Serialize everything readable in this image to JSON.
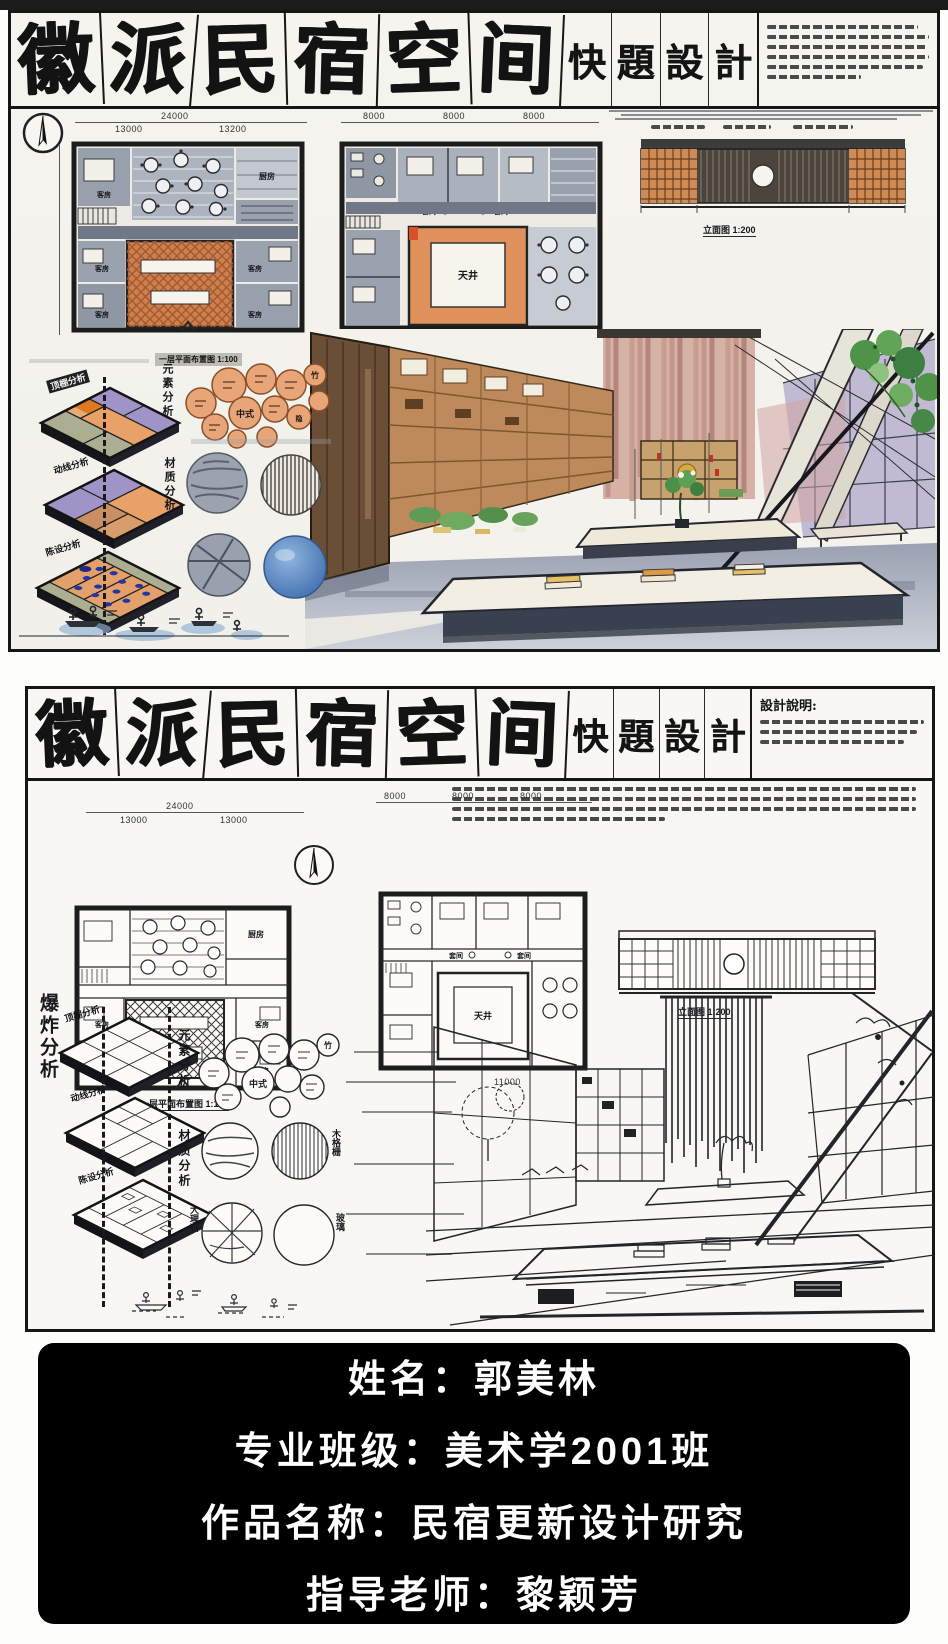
{
  "colors": {
    "ink": "#1a1a1a",
    "paper": "#f4f3ee",
    "wall_gray": "#98a0ad",
    "courtyard_orange": "#cf7f4e",
    "frame_orange": "#e0915c",
    "plate_orange": "#e8a268",
    "plate_purple": "#9f93c8",
    "plate_green": "#abae90",
    "dot_blue": "#2436a4",
    "bubble_orange": "#e8a577",
    "glass_blue": "#4f7db8",
    "wood_brown": "#6b4e36",
    "shelf_orange": "#bf8a5b",
    "curtain_pink": "#d7b1a5",
    "floor_gray": "#9ba1b2",
    "plant_green": "#4f9349",
    "book_yellow": "#e7c063",
    "card_bg": "#000000",
    "card_text": "#ffffff"
  },
  "board1": {
    "title_chars": [
      "徽",
      "派",
      "民",
      "宿",
      "空",
      "间"
    ],
    "subtitle_chars": [
      "快",
      "題",
      "設",
      "計"
    ],
    "labels": {
      "plan1": "一层平面布置图 1:100",
      "plan2": "二层平面布置图 1:100",
      "elevation": "立面图 1:200",
      "kitchen": "厨房",
      "guest": "客房",
      "courtyard": "天井",
      "suite": "套间",
      "elements": "元素分析",
      "materials": "材质分析",
      "plates": [
        "顶棚分析",
        "动线分析",
        "陈设分析"
      ],
      "bubbles": [
        "中式",
        "竹",
        "隐"
      ]
    },
    "dims": {
      "top": "24000",
      "topA": [
        "13000",
        "13200"
      ],
      "topB": [
        "8000",
        "8000",
        "8000"
      ],
      "bottomB": [
        "11890",
        "2600",
        "11800"
      ]
    }
  },
  "board2": {
    "title_chars": [
      "徽",
      "派",
      "民",
      "宿",
      "空",
      "间"
    ],
    "subtitle_chars": [
      "快",
      "題",
      "設",
      "計"
    ],
    "desc_title": "設計說明:",
    "labels": {
      "plan1": "一层平面布置图 1:100",
      "elevation": "立面图 1:200",
      "kitchen": "厨房",
      "guest": "客房",
      "courtyard": "天井",
      "suite": "套间",
      "exploded": "爆炸分析",
      "elements": "元素分析",
      "materials": "材质分析",
      "plates": [
        "顶棚分析",
        "动线分析",
        "陈设分析"
      ],
      "bubbles": [
        "中式",
        "竹"
      ],
      "circles": [
        "木格栅",
        "大理石",
        "玻璃"
      ]
    },
    "dims": {
      "top": "24000",
      "topA": [
        "13000",
        "13000"
      ],
      "topB": [
        "8000",
        "8000",
        "8000"
      ],
      "bottom": "11000"
    }
  },
  "card": {
    "lines": [
      "姓名：郭美林",
      "专业班级：美术学2001班",
      "作品名称：民宿更新设计研究",
      "指导老师：黎颖芳"
    ]
  }
}
